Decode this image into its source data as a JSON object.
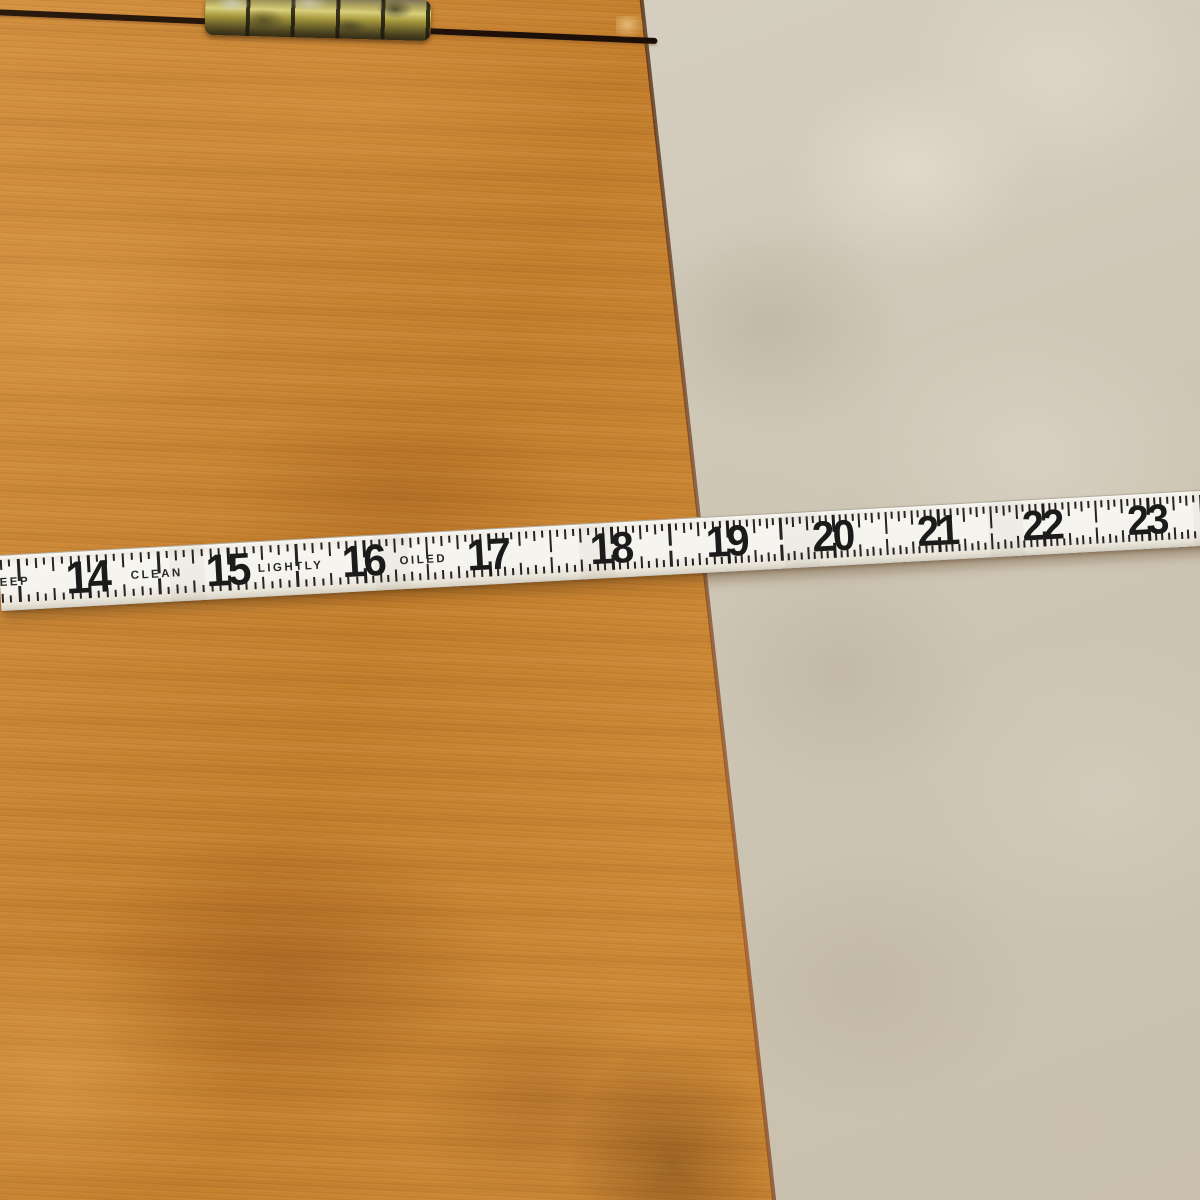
{
  "scene": {
    "description": "Photograph of a white folding rule lying across an orange-toned wooden tabletop with a brass barrel hinge; beige mottled floor visible to the right",
    "objects": [
      "wooden tabletop",
      "lid seam",
      "brass hinge",
      "folding rule",
      "beige floor"
    ]
  },
  "ruler": {
    "type": "folding rule, inch scale",
    "units": "inches",
    "ticks_per_inch": 16,
    "inch_marks": [
      {
        "label": "14",
        "x": 88
      },
      {
        "label": "15",
        "x": 228
      },
      {
        "label": "16",
        "x": 364
      },
      {
        "label": "17",
        "x": 489
      },
      {
        "label": "18",
        "x": 612
      },
      {
        "label": "19",
        "x": 728
      },
      {
        "label": "20",
        "x": 834
      },
      {
        "label": "21",
        "x": 939
      },
      {
        "label": "22",
        "x": 1044
      },
      {
        "label": "23",
        "x": 1149
      }
    ],
    "words": [
      {
        "text": "EEP",
        "x": 15
      },
      {
        "text": "CLEAN",
        "x": 157
      },
      {
        "text": "LIGHTLY",
        "x": 291
      },
      {
        "text": "OILED",
        "x": 424
      }
    ],
    "colors": {
      "face": "#f5f3ed",
      "markings": "#1d1d1d"
    }
  },
  "wood": {
    "colors": {
      "base": "#c5812f",
      "light": "#daa050",
      "dark_patch": "#9c6220",
      "edge_rim": "#7a3c14",
      "seam": "#20120a"
    }
  },
  "hinge": {
    "material": "brass",
    "knuckles": 5,
    "colors": {
      "bright": "#d9cf7c",
      "mid": "#a89a3e",
      "tarnish": "#3c3820",
      "glint": "#cfd0c8"
    }
  },
  "floor": {
    "colors": {
      "base": "#cfc7b6",
      "light": "#e0d9cb",
      "dark": "#b5aa97"
    }
  }
}
